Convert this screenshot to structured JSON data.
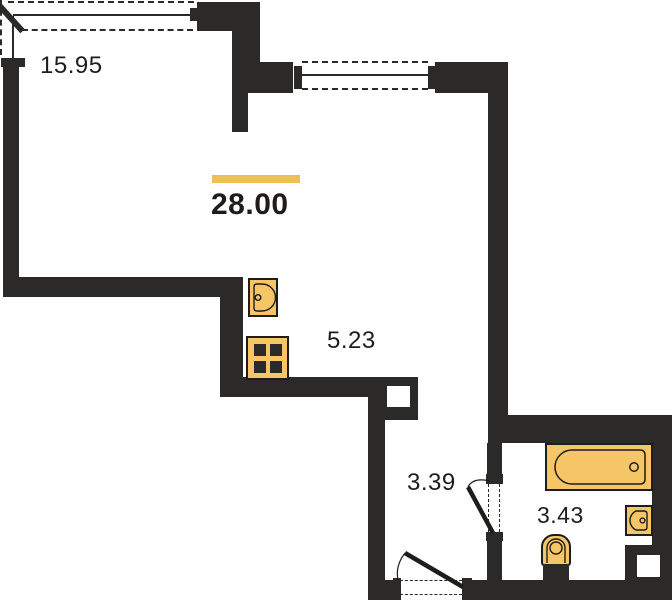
{
  "plan": {
    "title": "studio-apartment-floor-plan",
    "total_area": {
      "value": "28.00",
      "highlighted": true
    },
    "rooms": [
      {
        "id": "living-room",
        "area": "15.95"
      },
      {
        "id": "kitchen",
        "area": "5.23"
      },
      {
        "id": "hallway",
        "area": "3.39"
      },
      {
        "id": "bathroom",
        "area": "3.43"
      }
    ],
    "fixtures": [
      "kitchen-sink-icon",
      "stove-icon",
      "bathtub-icon",
      "toilet-icon",
      "washbasin-icon"
    ],
    "openings": [
      "entrance-door",
      "bathroom-door",
      "window-living",
      "window-kitchen",
      "corner-window"
    ],
    "ducts": [
      "duct-kitchen",
      "duct-bathroom"
    ]
  },
  "colors": {
    "wall": "#2b2a28",
    "fixture_fill": "#f5c566",
    "accent_bar": "#efbf5b",
    "text": "#1e1d1b",
    "background": "#ffffff"
  }
}
